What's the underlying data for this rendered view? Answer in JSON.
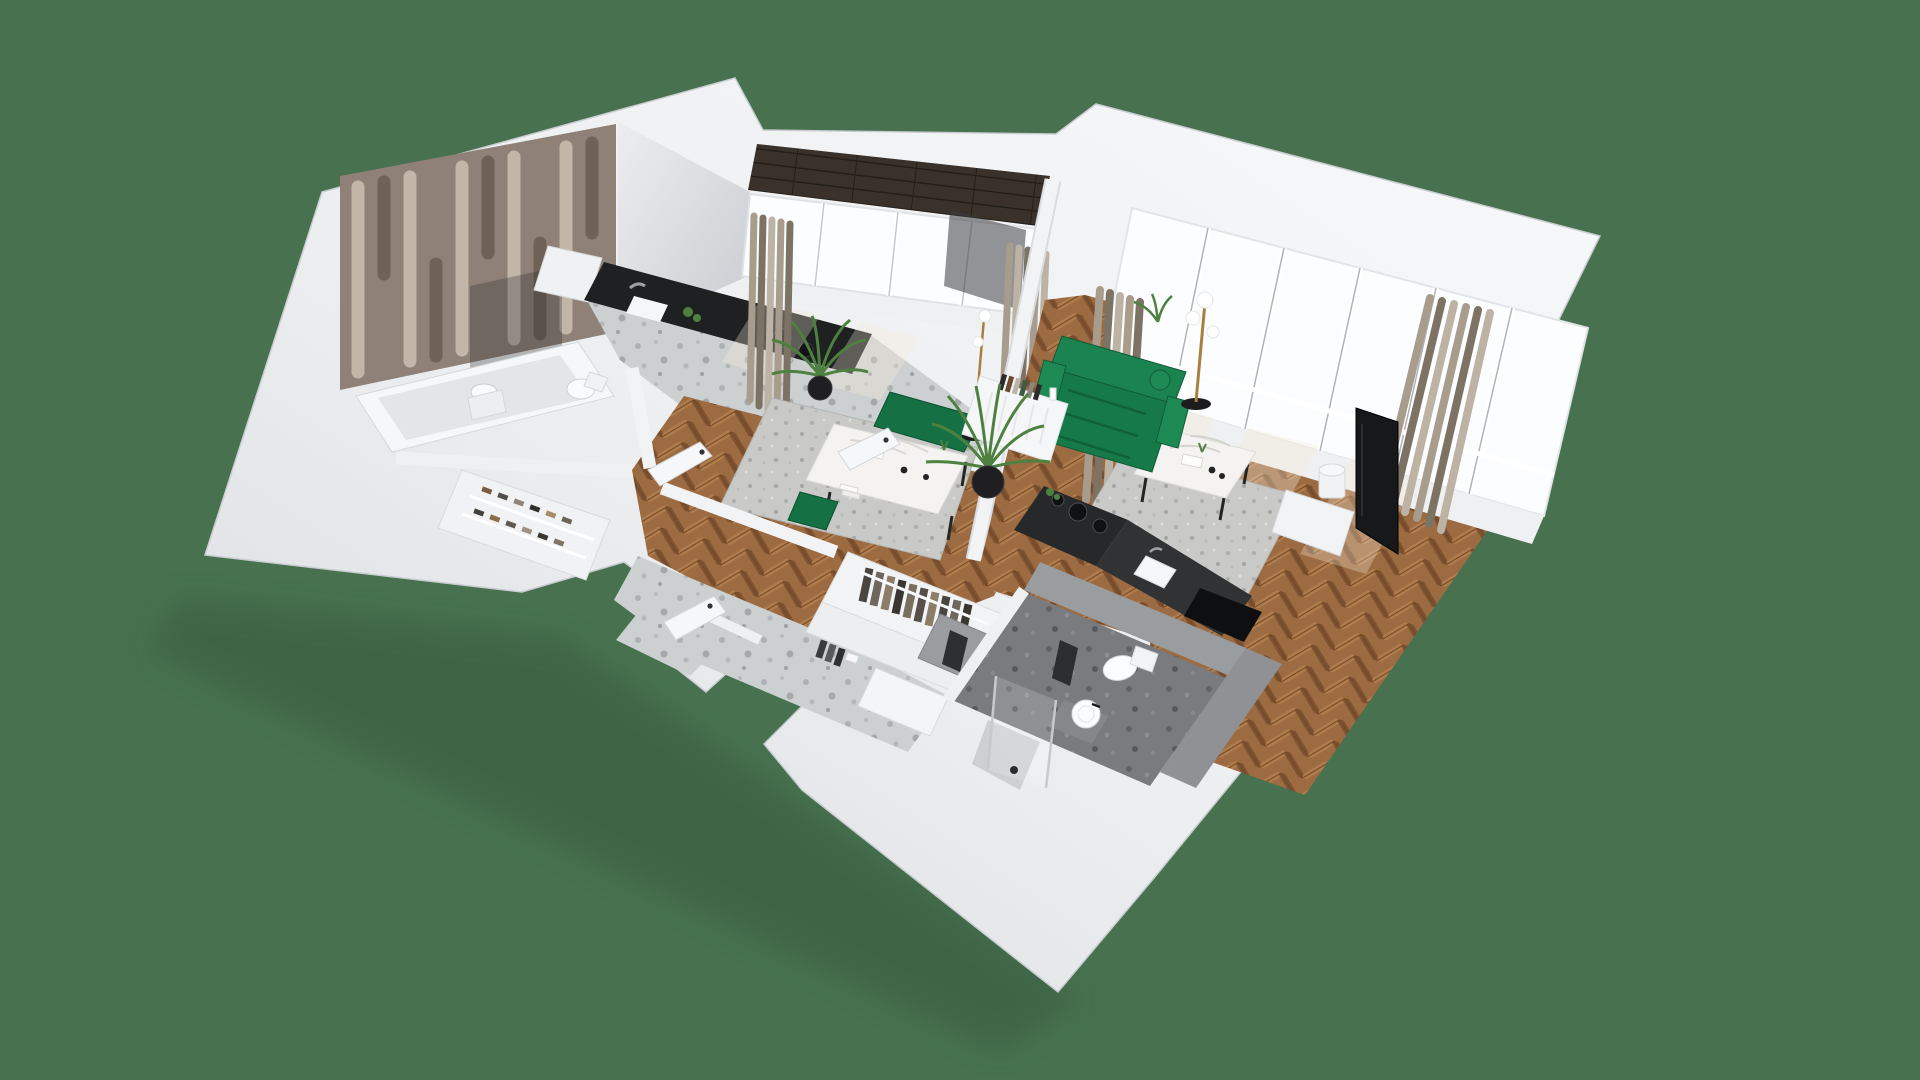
{
  "scene": {
    "type": "isometric-3d-floorplan-render",
    "description": "3D cutaway rendering of a furnished apartment on a plain green backdrop",
    "background_color": "#47714f",
    "rooms": [
      {
        "name": "kitchen-dining-room",
        "floor": "oak-herringbone"
      },
      {
        "name": "living-room",
        "floor": "oak-herringbone"
      },
      {
        "name": "hallway",
        "floor": "light-terrazzo"
      },
      {
        "name": "bathroom",
        "floor": "dark-terrazzo"
      },
      {
        "name": "ensuite-bathroom",
        "floor": "light-terrazzo"
      },
      {
        "name": "walk-in-closet",
        "floor": "light-terrazzo"
      },
      {
        "name": "balcony",
        "floor": "dark-wood-deck"
      }
    ],
    "furniture": [
      "green-velvet-sofa",
      "marble-coffee-table",
      "gray-shag-rug",
      "brass-floor-lamp",
      "tv-panel",
      "white-sideboard-with-books",
      "potted-palm",
      "marble-dining-table",
      "green-dining-bench",
      "black-kitchen-counter-with-hob",
      "kitchen-sink",
      "bathtub",
      "walk-in-shower",
      "toilet",
      "round-wash-basin",
      "open-wardrobe-rack",
      "shoe-rack",
      "storage-bench",
      "curtains",
      "window-walls",
      "decorative-3d-panel-wall"
    ]
  },
  "palette": {
    "background": "#47714f",
    "shadow": "#34583d",
    "wall_top": "#f6f7f8",
    "wall_mid": "#e9ebed",
    "wall_dark": "#d7dadd",
    "wall_gray": "#9a9da0",
    "corner_wall": "#dfe2e5",
    "floor_wood": "#9d6b41",
    "floor_wood_light": "#b07c4c",
    "floor_wood_dark": "#7e5230",
    "terrazzo_light": "#cdd0d1",
    "terrazzo_dark": "#797b7e",
    "deck": "#3a322a",
    "glass": "#fcfdfe",
    "mullion": "#aeb3b7",
    "curtain": "#a89c8d",
    "curtain_dark": "#7d7365",
    "curtain_light": "#bdb3a4",
    "sofa_green": "#167a48",
    "sofa_green_light": "#1d8a54",
    "sofa_green_dark": "#0f5c36",
    "dining_green": "#157043",
    "rug": "#c9cac8",
    "marble": "#f4f3f1",
    "counter_black": "#1e2022",
    "counter_gray": "#303234",
    "accent_wall": "#8f8177",
    "accent_ridge": "#c2b6a9",
    "accent_groove": "#6e6257",
    "plant": "#4e8040",
    "pot_black": "#1f1f21",
    "brass": "#a97f3f",
    "fixture_white": "#fafbfc",
    "door_white": "#f6f7f8",
    "tv_black": "#17181a",
    "dark_textile": "#2e2f31",
    "gray_cabinet": "#9a9c9f"
  }
}
